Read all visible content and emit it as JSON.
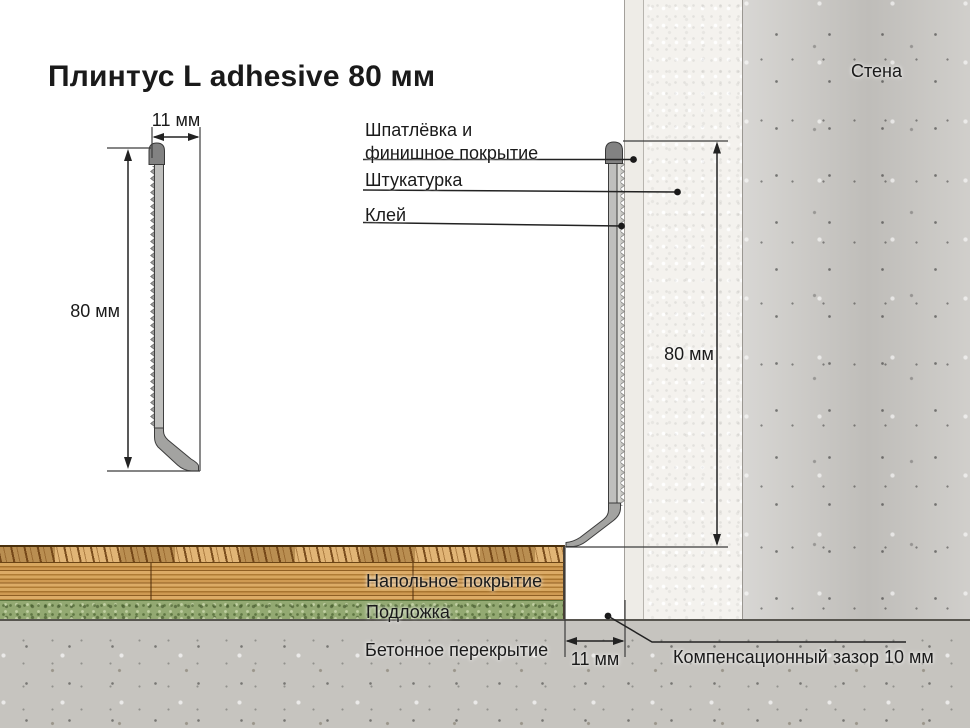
{
  "title": "Плинтус L adhesive 80 мм",
  "colors": {
    "ink": "#1a1a1a",
    "profile-body": "#bfbfbd",
    "profile-cap": "#828282",
    "glue": "#d8d8d4",
    "putty": "#eeece7",
    "plaster": "#f4f2ee",
    "concrete-wall": "#c9c7c3",
    "concrete-slab": "#c6c4bf",
    "wood-base": "#cf9a52",
    "underlay": "#93a972"
  },
  "left_detail": {
    "width_label": "11 мм",
    "height_label": "80 мм"
  },
  "wall_section": {
    "wall_label": "Стена",
    "height_label": "80 мм",
    "layer_labels": [
      {
        "label": "Шпатлёвка и финишное покрытие"
      },
      {
        "label": "Штукатурка"
      },
      {
        "label": "Клей"
      }
    ]
  },
  "floor_section": {
    "labels": [
      "Напольное покрытие",
      "Подложка",
      "Бетонное перекрытие"
    ],
    "foot_width_label": "11 мм",
    "gap_label": "Компенсационный зазор 10 мм"
  }
}
